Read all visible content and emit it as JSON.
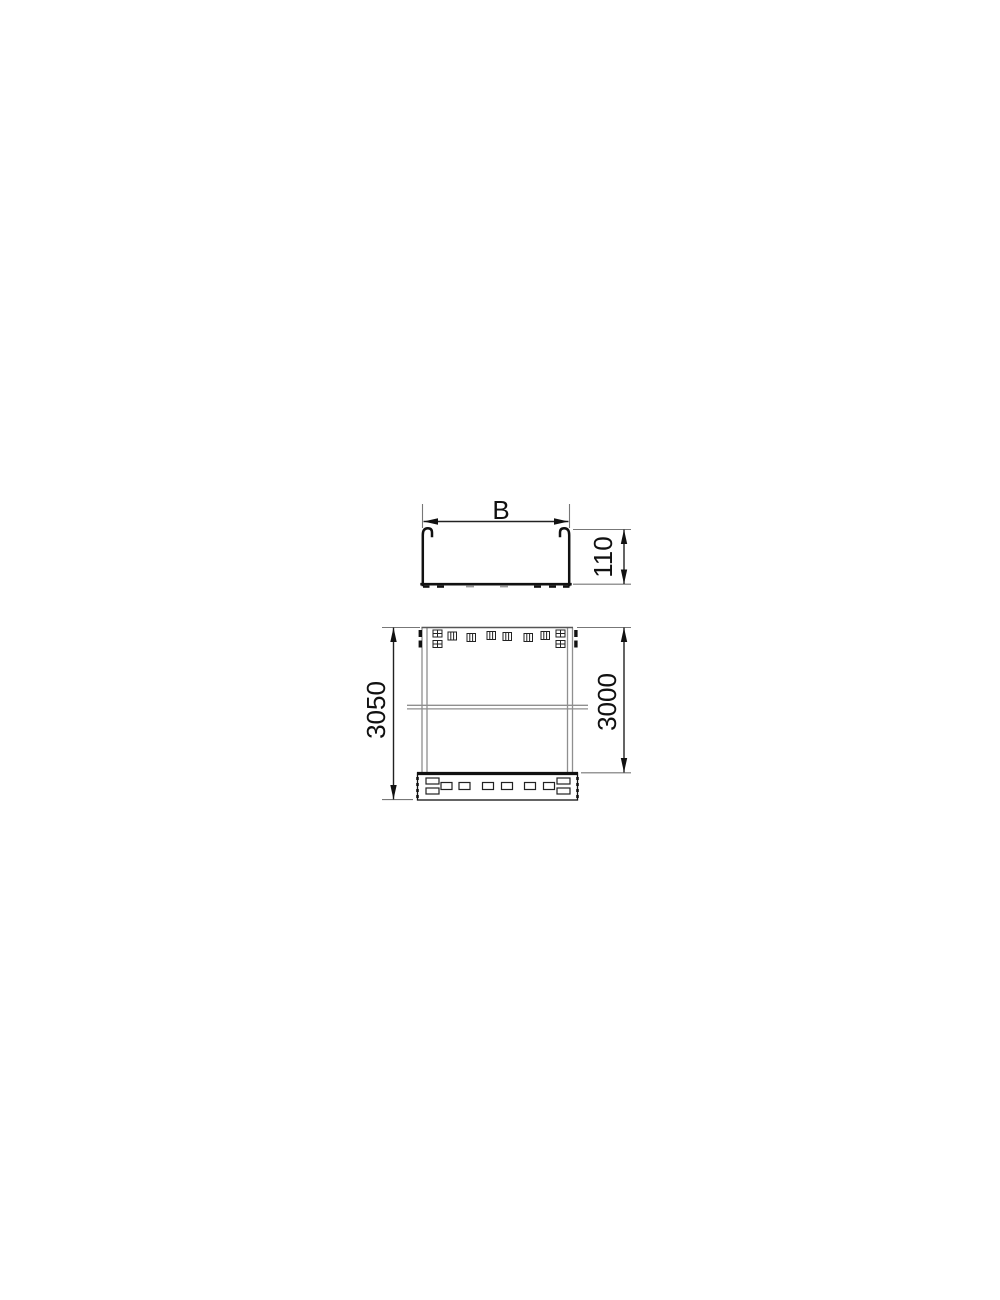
{
  "drawing": {
    "labels": {
      "width": "B",
      "height": "110",
      "overall_length": "3050",
      "effective_length": "3000"
    },
    "colors": {
      "background": "#ffffff",
      "heavy_line": "#111111",
      "dimension_line": "#222222",
      "extension_line": "#777777",
      "wall_line": "#8f8f8f",
      "text": "#111111"
    }
  }
}
